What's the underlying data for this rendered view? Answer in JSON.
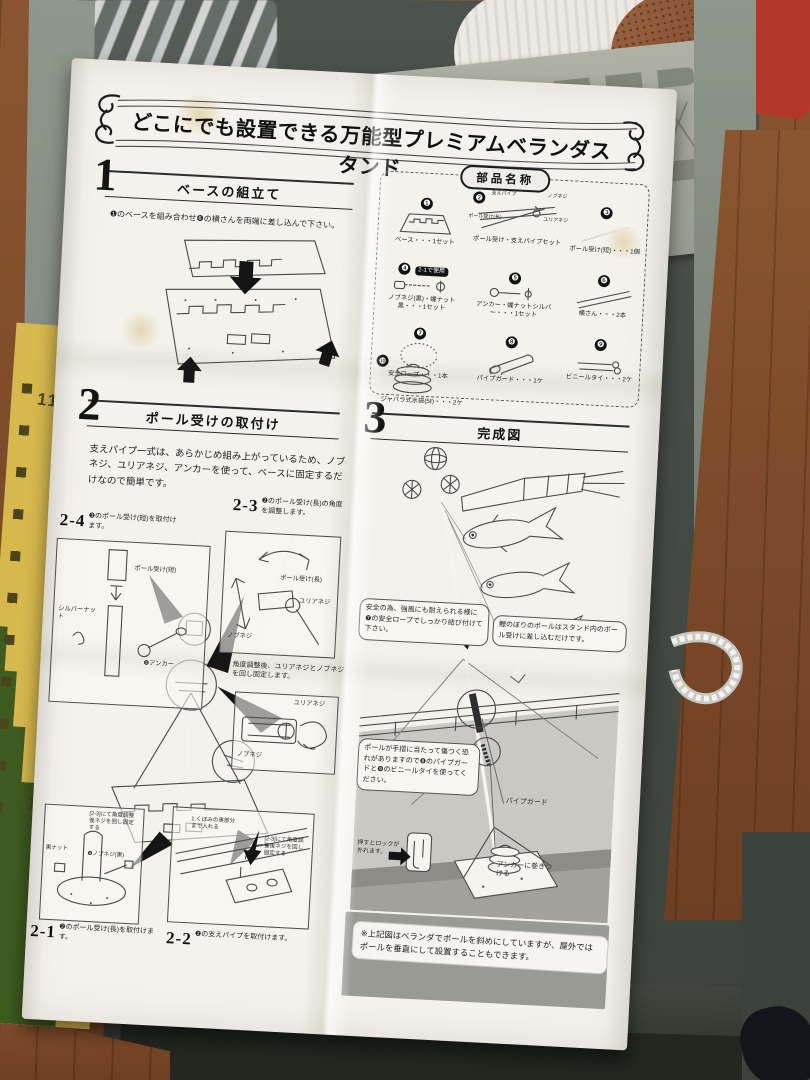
{
  "colors": {
    "paper": "#f4f2ec",
    "box_gray": "#8f978c",
    "wood_floor": "#8a5530",
    "chart_yellow": "#d7b84d",
    "chart_green": "#3f5c20",
    "red_item": "#b5372c",
    "copper_item": "#8a5434",
    "ink": "#222222"
  },
  "ruler": {
    "mark_110": "110",
    "mark_100": "100"
  },
  "sheet": {
    "title": "どこにでも設置できる万能型プレミアムベランダスタンド",
    "step1": {
      "number": "1",
      "heading": "ベースの組立て",
      "instruction": "❶のベースを組み合わせ❻の横さんを両端に差し込んで下さい。"
    },
    "parts": {
      "heading": "部品名称",
      "items": [
        {
          "num": "❶",
          "label": "ベース・・・1セット"
        },
        {
          "num": "❷",
          "label": "ポール受け・支えパイプセット",
          "sublabels": [
            "支えパイプ",
            "ノブネジ",
            "ポール受け(長)",
            "ユリアネジ"
          ]
        },
        {
          "num": "❸",
          "label": "ポール受け(短)・・・1個"
        },
        {
          "num": "❹",
          "label": "ノブネジ(黒)・蝶ナット黒・・・1セット",
          "badge": "2-1で使用"
        },
        {
          "num": "❺",
          "label": "アンカー・蝶ナットシルバー・・・1セット"
        },
        {
          "num": "❻",
          "label": "横さん・・・2本"
        },
        {
          "num": "❼",
          "label": "安全ロープ・・・1本"
        },
        {
          "num": "❽",
          "label": "パイプガード・・・1ケ"
        },
        {
          "num": "❾",
          "label": "ビニールタイ・・・2ケ"
        },
        {
          "num": "❿",
          "label": "ジャバラ式水袋(5ℓ)・・・2ケ"
        }
      ]
    },
    "step2": {
      "number": "2",
      "heading": "ポール受けの取付け",
      "intro": "支えパイプ一式は、あらかじめ組み上がっているため、ノブネジ、ユリアネジ、アンカーを使って、ベースに固定するだけなので簡単です。",
      "s23_id": "2-3",
      "s23_text": "❷のポール受け(長)の角度を調整します。",
      "s23_label_pole": "ポール受け(長)",
      "s23_label_urea": "ユリアネジ",
      "s23_label_knob": "ノブネジ",
      "s24_id": "2-4",
      "s24_text": "❸のポール受け(短)を取付けます。",
      "s24_label_pole": "ポール受け(短)",
      "s24_label_silver": "シルバーナット",
      "s24_label_anchor": "❺アンカー",
      "fix_text": "角度調整後、ユリアネジとノブネジを回し固定します。",
      "fix_label_urea": "ユリアネジ",
      "fix_label_knob": "ノブネジ",
      "s21_id": "2-1",
      "s21_text": "❷のポール受け(長)を取付けます。",
      "s21_label_nut": "黒ナット",
      "s21_label_note": "[2-3]にて角度調整後ネジを回し固定する",
      "s21_label_knob": "❹ノブネジ(黒)",
      "s22_id": "2-2",
      "s22_text": "❷の支えパイプを取付けます。",
      "s22_label_insert": "1.くぼみの奥部分まで入れる",
      "s22_label_note": "[2-3]にて角度調整後ネジを回し固定する"
    },
    "step3": {
      "number": "3",
      "heading": "完成図",
      "bubble_rope": "安全の為、強風にも耐えられる様に❼の安全ロープでしっかり結び付けて下さい。",
      "bubble_pole": "鯉のぼりのポールはスタンド内のポール受けに差し込むだけです。",
      "bubble_guard": "ポールが手摺に当たって傷つく恐れがありますので❽のパイプガードと❾のビニールタイを使ってください。",
      "lock_note": "押すとロックが外れます。",
      "label_pipe_guard": "パイプガード",
      "label_anchor": "アンカーに巻きつける",
      "footnote": "※上記図はベランダでポールを斜めにしていますが、屋外ではポールを垂直にして設置することもできます。"
    }
  }
}
